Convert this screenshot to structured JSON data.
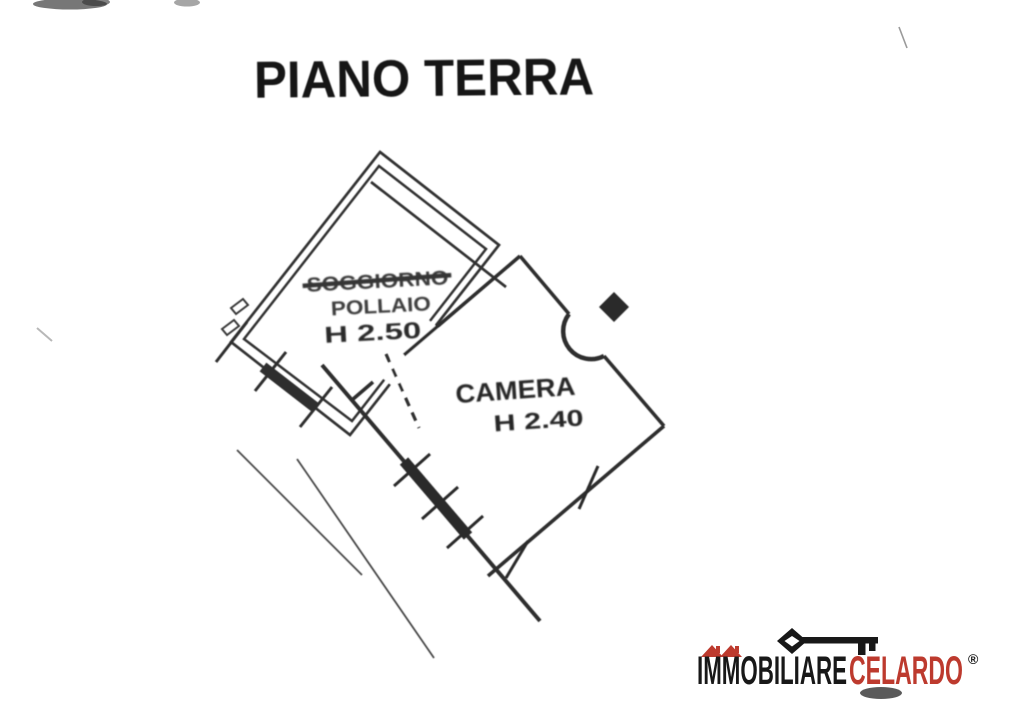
{
  "document": {
    "title": "PIANO TERRA"
  },
  "floor_plan": {
    "room_annex": {
      "crossed_out_label": "SOGGIORNO",
      "label": "POLLAIO",
      "height_label": "H 2.50"
    },
    "room_camera": {
      "label": "CAMERA",
      "height_label": "H 2.40"
    }
  },
  "logo": {
    "word_black": "IMMOBILIARE",
    "word_red": "CELARDO",
    "registered_mark": "®",
    "color_red": "#bd3a2e",
    "color_black": "#181818"
  },
  "colors": {
    "ink": "#333333",
    "paper": "#ffffff"
  }
}
